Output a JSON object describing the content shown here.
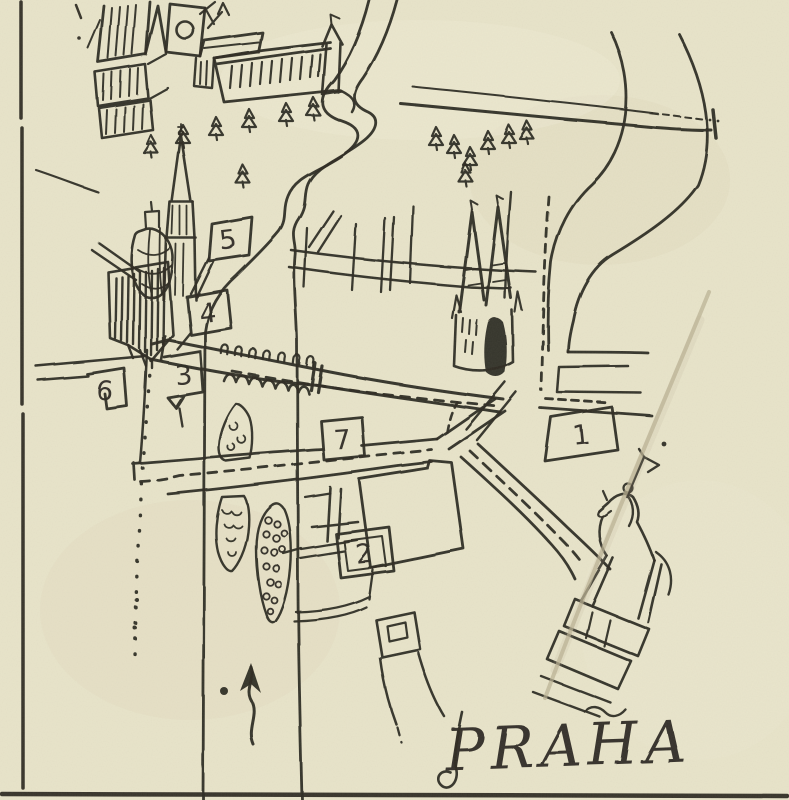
{
  "title": {
    "text": "PRAHA"
  },
  "markers": {
    "m1": {
      "label": "1"
    },
    "m2": {
      "label": "2"
    },
    "m3": {
      "label": "3"
    },
    "m4": {
      "label": "4"
    },
    "m5": {
      "label": "5"
    },
    "m6": {
      "label": "6"
    },
    "m7": {
      "label": "7"
    }
  },
  "map_symbols": {
    "tree_icon": "fir-tree",
    "flag_marker_icon": "numbered-flag",
    "route_icon": "dashed-route-line",
    "north_arrow_icon": "wavy-up-arrow",
    "bridge_icon": "arched-bridge-with-statues"
  },
  "colors": {
    "paper": "#e9e5cb",
    "ink": "#2d2a22",
    "crease": "#b9b093",
    "stain": "#ddd8ba"
  }
}
